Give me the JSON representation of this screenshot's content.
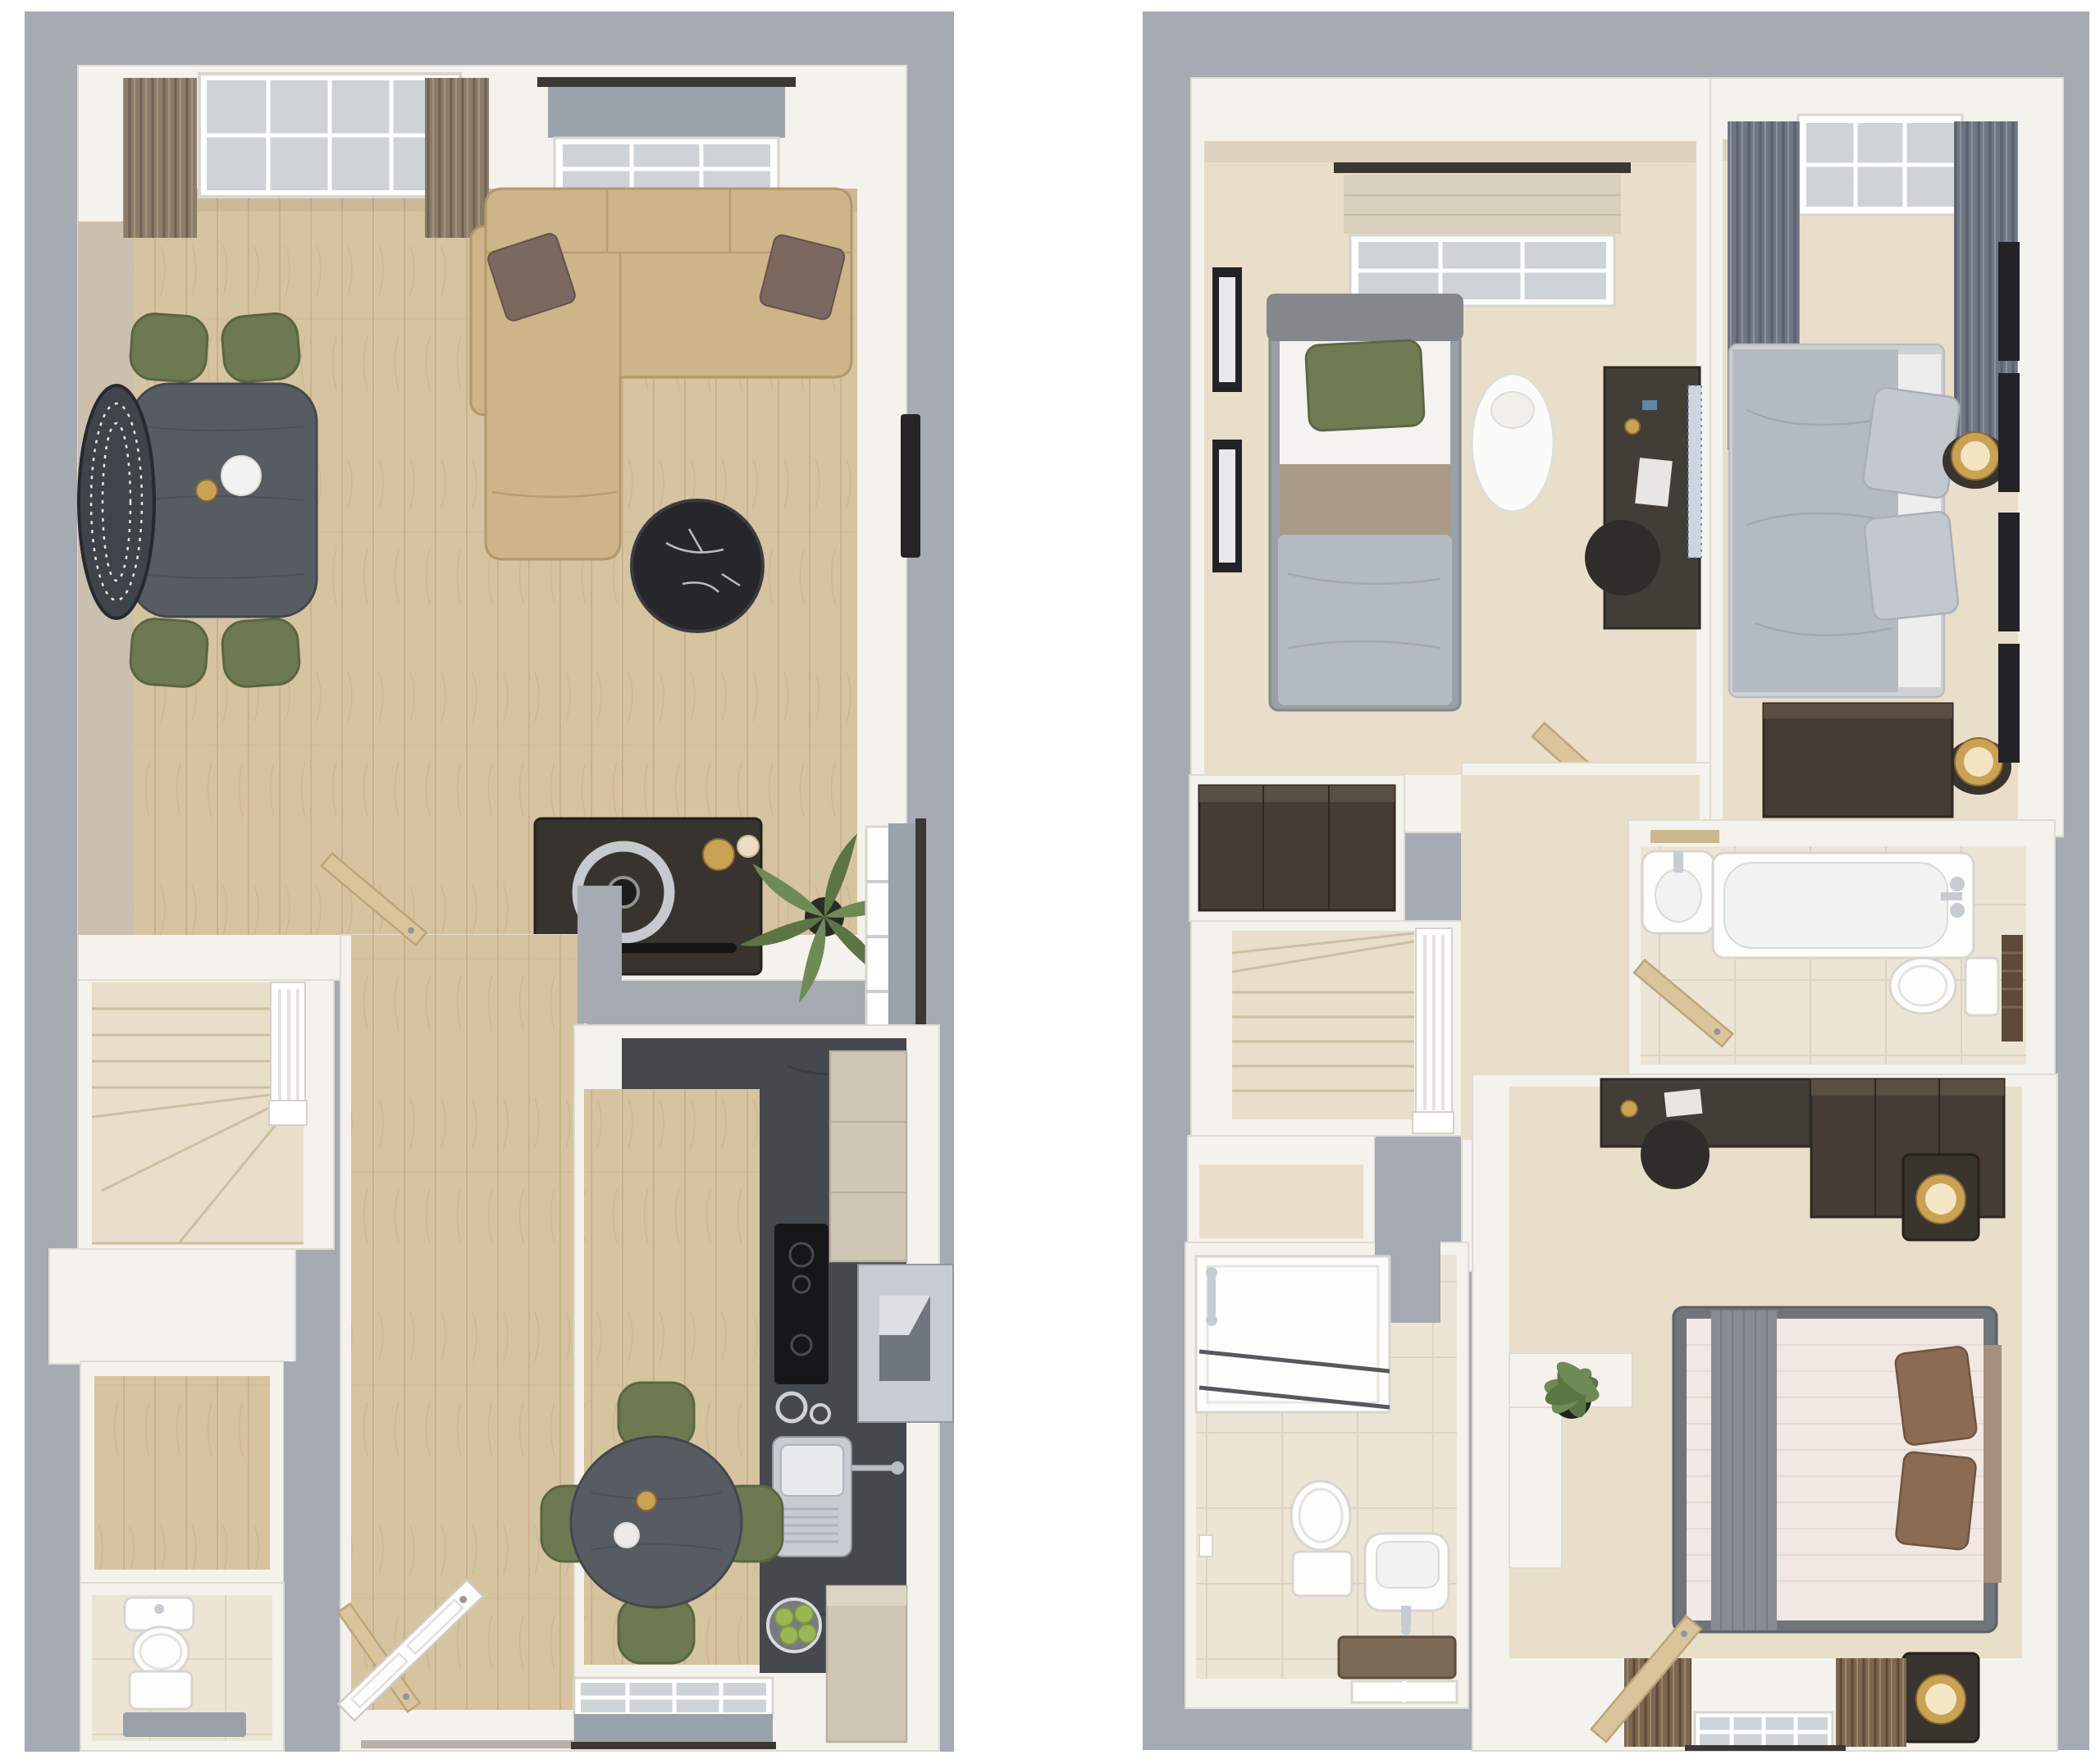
{
  "image_type": "3d-floor-plan-rendering",
  "floors": [
    {
      "id": "ground-floor",
      "label": "Ground floor plan",
      "rooms": [
        {
          "name": "living-dining-room",
          "furniture": [
            "bifold-patio-door",
            "taupe-curtains",
            "window-roman-blind",
            "corner-sofa",
            "scatter-cushions",
            "marble-coffee-table",
            "dining-table",
            "dining-chairs-x4",
            "patterned-rug",
            "media-sideboard",
            "record-player",
            "palm-plant",
            "wall-tv",
            "side-window-roman-blind"
          ]
        },
        {
          "name": "hallway",
          "furniture": [
            "staircase",
            "balustrade",
            "understairs-store",
            "oak-internal-doors",
            "front-door"
          ]
        },
        {
          "name": "storage-cupboard",
          "furniture": []
        },
        {
          "name": "cloakroom-wc",
          "furniture": [
            "toilet",
            "hand-basin",
            "bath-mat"
          ]
        },
        {
          "name": "kitchen-breakfast-room",
          "furniture": [
            "charcoal-worktop-run",
            "induction-hob",
            "extractor-hood",
            "wall-units",
            "sink-drainer",
            "mixer-tap",
            "fruit-bowl",
            "bistro-table",
            "dining-chairs-x4",
            "window-roman-blind"
          ]
        }
      ]
    },
    {
      "id": "first-floor",
      "label": "First floor plan",
      "rooms": [
        {
          "name": "bedroom-3",
          "furniture": [
            "window-roman-blind",
            "single-bed",
            "green-cushion",
            "pedestal-side-table",
            "desk",
            "desk-chair",
            "wall-art-x2",
            "wardrobe"
          ]
        },
        {
          "name": "bedroom-1",
          "furniture": [
            "curtained-window",
            "double-bed",
            "stacked-pillows",
            "bedside-lamps-x2",
            "chest-of-drawers",
            "wall-art-x4"
          ]
        },
        {
          "name": "bathroom",
          "furniture": [
            "bath",
            "chrome-mixer",
            "wash-basin",
            "toilet",
            "wooden-shelf",
            "towel-stack"
          ]
        },
        {
          "name": "landing",
          "furniture": [
            "staircase",
            "balustrade",
            "airing-cupboard",
            "oak-internal-doors"
          ]
        },
        {
          "name": "bedroom-2",
          "furniture": [
            "desk",
            "desk-chair",
            "wardrobe",
            "bedside-tables-x2",
            "table-lamps-x2",
            "double-bed",
            "grey-throw-runner",
            "brown-cushions",
            "curtained-window",
            "potted-plant",
            "half-wall-ledge"
          ]
        },
        {
          "name": "en-suite",
          "furniture": [
            "shower-enclosure",
            "shower-valve",
            "toilet",
            "wash-basin",
            "bath-mat",
            "window"
          ]
        }
      ]
    }
  ],
  "colors": {
    "canvas": "#ffffff",
    "slab": "#a6aab2",
    "wall": "#f4f2ec",
    "wallEdge": "#dedbd3",
    "wallpaper": "#cbc0ae",
    "wood": "#d6c3a0",
    "woodLine": "#c2aa84",
    "carpet": "#e8dec9",
    "carpetLine": "#cdbfa2",
    "tile": "#ece5d5",
    "tileLine": "#dcd4c1",
    "charcoal": "#45494e",
    "sofa": "#cdb489",
    "sofaEdge": "#b3976b",
    "cushion": "#7b685e",
    "olive": "#6d7950",
    "oliveEdge": "#59663f",
    "darkTable": "#575c63",
    "marble": "#27262a",
    "curtainTaupe": "#8c7c6a",
    "curtainGray": "#6f7682",
    "curtainBrown": "#7c6750",
    "blindGray": "#9aa3ac",
    "blindBeige": "#d8cfbc",
    "cabinet": "#cfc6b6",
    "cabinetEdge": "#b8af9e",
    "darkWood": "#463c33",
    "darkWoodEdge": "#2f2822",
    "steel": "#c6ccd2",
    "steelEdge": "#8f969e",
    "appliance": "#17171a",
    "gold": "#c9a254",
    "white": "#fdfdfc",
    "fixtureEdge": "#d8d5ce",
    "bedGray": "#b4bac1",
    "bedFrame": "#70757b",
    "bedWhite": "#f1e8e3",
    "pillowBrown": "#8b6c52",
    "pillowGray": "#c3c8ce",
    "greenLeaf": "#6e8a55",
    "greenDark": "#5b7544",
    "apple": "#9cb557",
    "matBrown": "#7b6a57",
    "woodDoor": "#d9c49c",
    "woodDoorEdge": "#bca578",
    "rodDark": "#3b3733",
    "frameBlack": "#232327",
    "glass": "#ced3d7",
    "towelBrown": "#5e4a38"
  }
}
